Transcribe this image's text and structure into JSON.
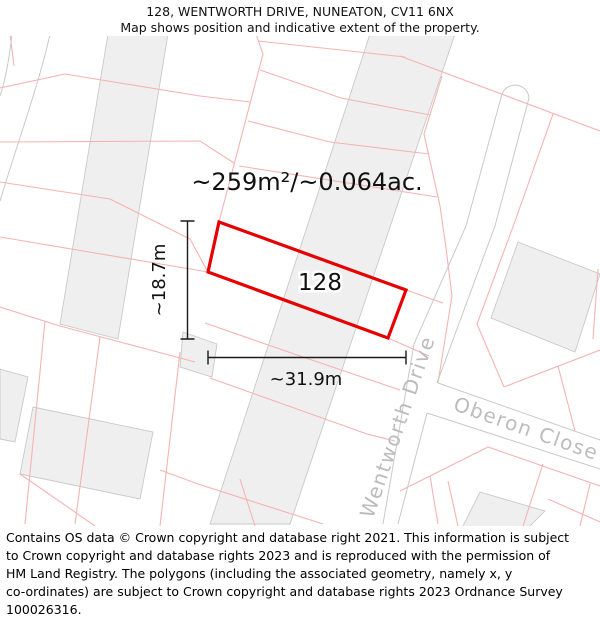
{
  "header": {
    "title": "128, WENTWORTH DRIVE, NUNEATON, CV11 6NX",
    "subtitle": "Map shows position and indicative extent of the property."
  },
  "map": {
    "plot_number": "128",
    "area_label": "~259m²/~0.064ac.",
    "width_label": "~31.9m",
    "height_label": "~18.7m",
    "streets": {
      "wentworth": "Wentworth Drive",
      "oberon": "Oberon Close"
    }
  },
  "footer": {
    "lines": [
      "Contains OS data © Crown copyright and database right 2021. This information is subject",
      "to Crown copyright and database rights 2023 and is reproduced with the permission of",
      "HM Land Registry. The polygons (including the associated geometry, namely x, y",
      "co-ordinates) are subject to Crown copyright and database rights 2023 Ordnance Survey",
      "100026316."
    ]
  },
  "colors": {
    "plot-outline": "#e60000",
    "parcel-line": "#f5b3b3",
    "building-fill": "#f0efef",
    "building-stroke": "#c9c9c9",
    "road-stroke": "#c9c9c9",
    "street-label": "#bcbcbc",
    "dimension": "#1a1a1a"
  }
}
